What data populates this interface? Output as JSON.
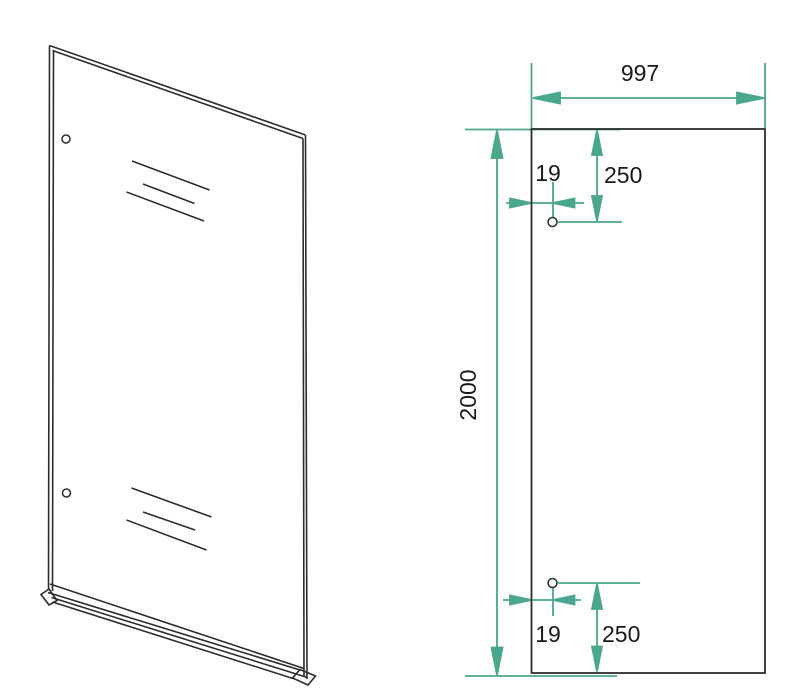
{
  "drawing": {
    "dimensions": {
      "width": "997",
      "height": "2000",
      "top_hole_edge_offset": "19",
      "top_hole_top_offset": "250",
      "bottom_hole_edge_offset": "19",
      "bottom_hole_bottom_offset": "250"
    },
    "colors": {
      "dimension_accent": "#4aa68d",
      "outline": "#2d2d2d",
      "background": "#ffffff"
    }
  }
}
